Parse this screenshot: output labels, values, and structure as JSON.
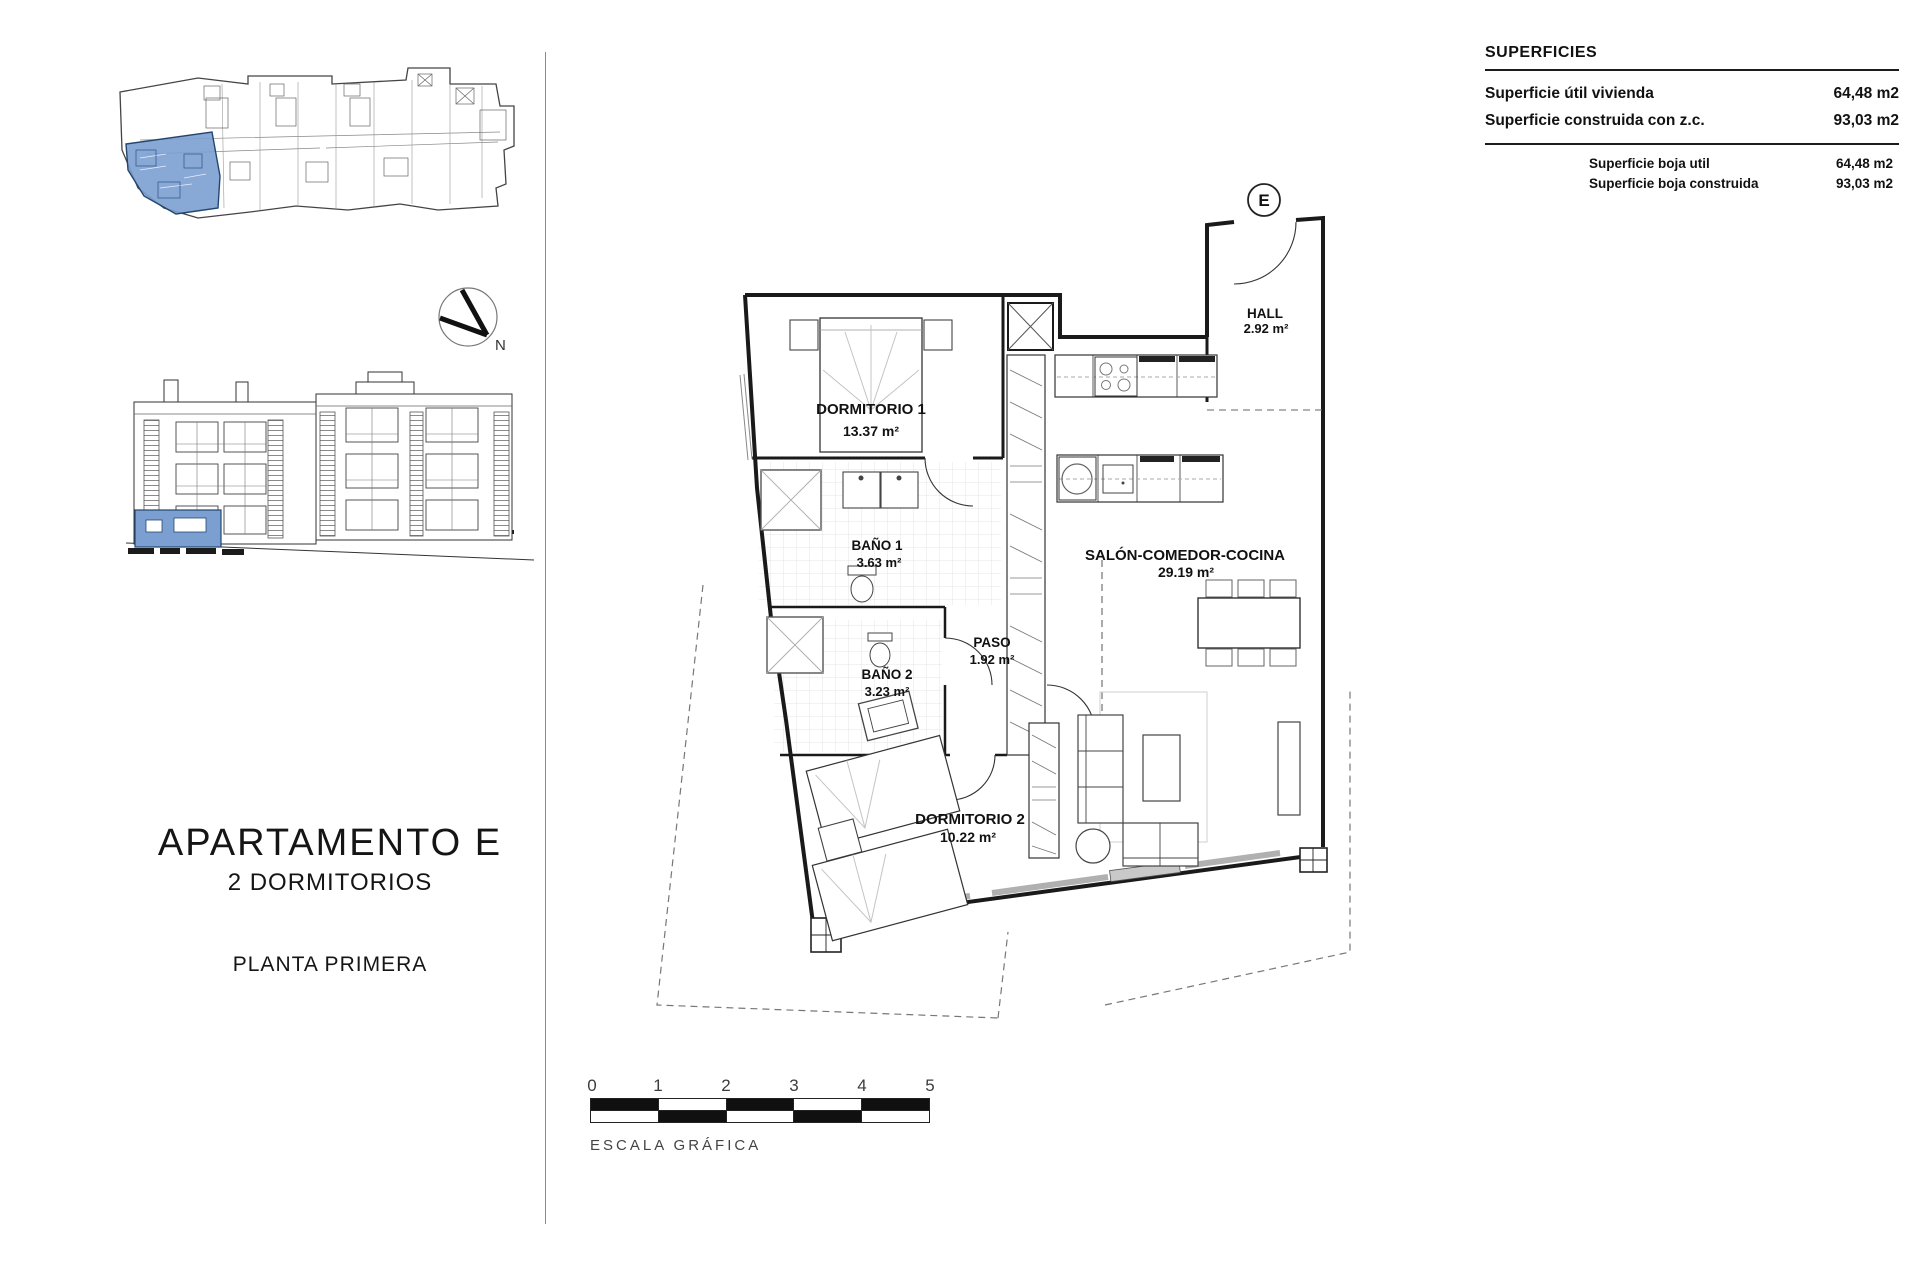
{
  "title_block": {
    "apartment": "APARTAMENTO E",
    "bedrooms": "2 DORMITORIOS",
    "floor": "PLANTA PRIMERA"
  },
  "superficies": {
    "heading": "SUPERFICIES",
    "rows": [
      {
        "label": "Superficie útil vivienda",
        "value": "64,48 m2"
      },
      {
        "label": "Superficie construida con z.c.",
        "value": "93,03 m2"
      }
    ],
    "subrows": [
      {
        "label": "Superficie boja util",
        "value": "64,48 m2"
      },
      {
        "label": "Superficie boja construida",
        "value": "93,03 m2"
      }
    ]
  },
  "plan": {
    "unit_label": "E",
    "rooms": [
      {
        "name": "DORMITORIO 1",
        "area": "13.37 m²"
      },
      {
        "name": "BAÑO 1",
        "area": "3.63 m²"
      },
      {
        "name": "BAÑO 2",
        "area": "3.23 m²"
      },
      {
        "name": "PASO",
        "area": "1.92 m²"
      },
      {
        "name": "DORMITORIO 2",
        "area": "10.22 m²"
      },
      {
        "name": "SALÓN-COMEDOR-COCINA",
        "area": "29.19 m²"
      },
      {
        "name": "HALL",
        "area": "2.92 m²"
      }
    ]
  },
  "north": {
    "label": "N"
  },
  "scale_bar": {
    "ticks": [
      "0",
      "1",
      "2",
      "3",
      "4",
      "5"
    ],
    "caption": "ESCALA GRÁFICA"
  },
  "colors": {
    "highlight_fill": "#7b9fd0",
    "highlight_stroke": "#24466e",
    "ink": "#1a1a1a"
  }
}
